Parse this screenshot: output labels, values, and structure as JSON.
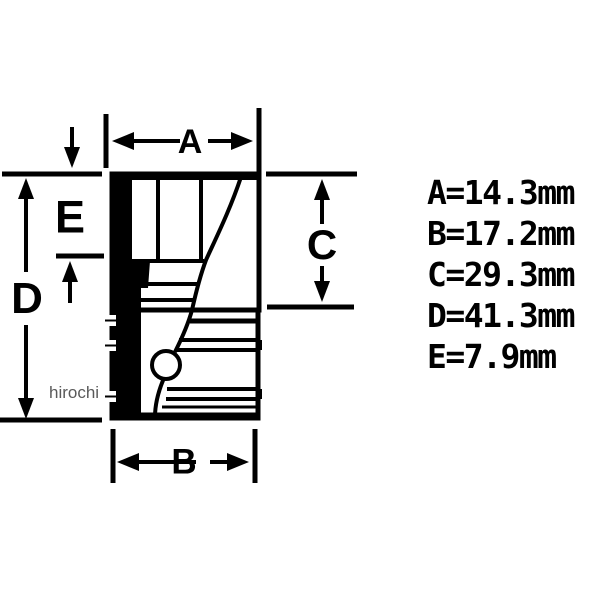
{
  "page": {
    "background_color": "#ffffff",
    "line_color": "#000000",
    "watermark_color": "#5a5a5a"
  },
  "drawing": {
    "kind": "socket cross-section dimension diagram",
    "dim_labels": {
      "a": "A",
      "b": "B",
      "c": "C",
      "d": "D",
      "e": "E"
    },
    "watermark": "hirochi"
  },
  "measurements": {
    "items": [
      "A=14.3mm",
      "B=17.2mm",
      "C=29.3mm",
      "D=41.3mm",
      "E=7.9mm"
    ],
    "unit": "mm",
    "values": {
      "A": 14.3,
      "B": 17.2,
      "C": 29.3,
      "D": 41.3,
      "E": 7.9
    }
  }
}
